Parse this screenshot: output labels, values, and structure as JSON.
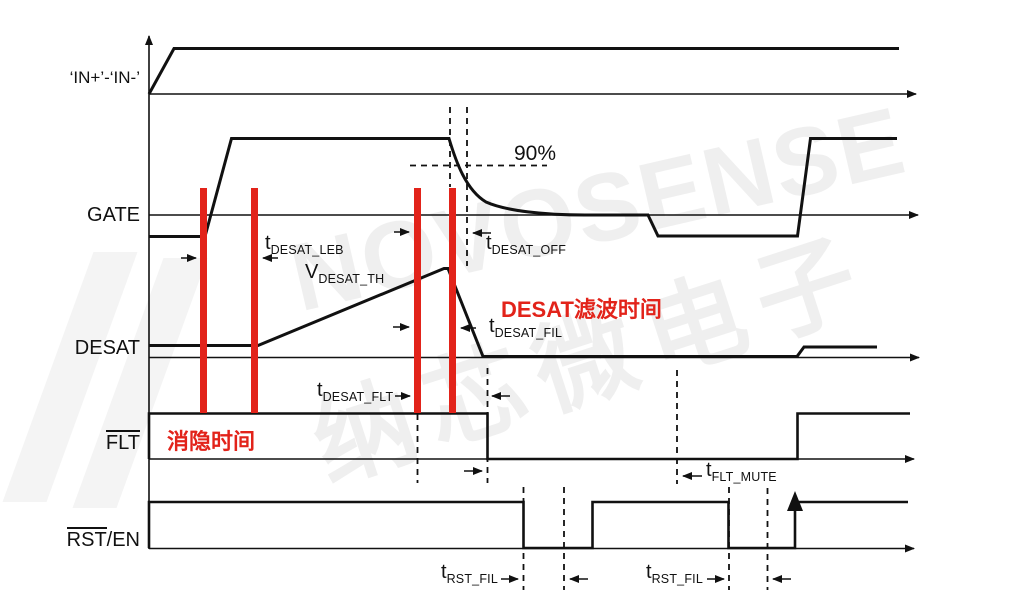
{
  "diagram": {
    "title": "DESAT fault timing diagram",
    "signals": {
      "in": "‘IN+’-‘IN-’",
      "gate": "GATE",
      "desat": "DESAT",
      "flt": "FLT",
      "rst_overlined": "RST",
      "rst_rest": "/EN"
    },
    "annotations": {
      "leb": {
        "main": "t",
        "sub": "DESAT_LEB"
      },
      "vth": {
        "main": "V",
        "sub": "DESAT_TH"
      },
      "off": {
        "main": "t",
        "sub": "DESAT_OFF"
      },
      "fil": {
        "main": "t",
        "sub": "DESAT_FIL"
      },
      "fltd": {
        "main": "t",
        "sub": "DESAT_FLT"
      },
      "mute": {
        "main": "t",
        "sub": "FLT_MUTE"
      },
      "rst1": {
        "main": "t",
        "sub": "RST_FIL"
      },
      "rst2": {
        "main": "t",
        "sub": "RST_FIL"
      },
      "pct": "90%",
      "blanking": "消隐时间",
      "desat_filter": "DESAT滤波时间"
    },
    "watermark": {
      "line1": "NOVOSENSE",
      "line2": "纳芯微电子"
    },
    "colors": {
      "accent_red": "#e2231a",
      "line_black": "#111111"
    }
  }
}
